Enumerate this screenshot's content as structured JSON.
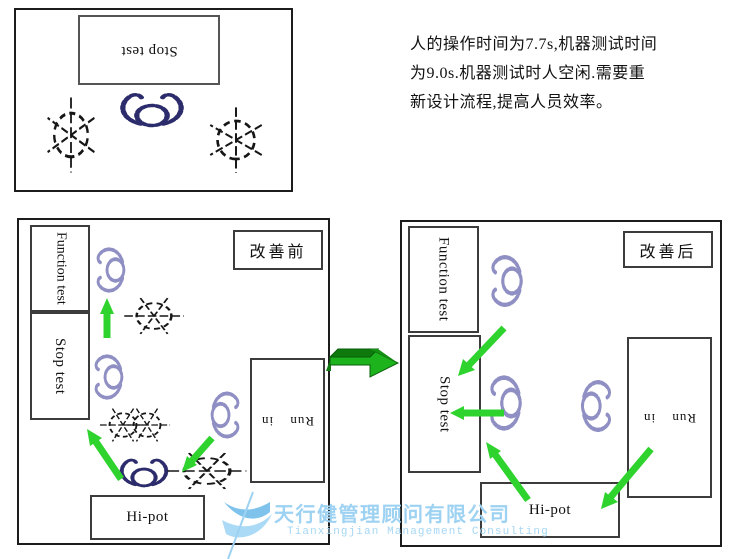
{
  "intro_panel": {
    "stop_test": "Stop test"
  },
  "note": {
    "text": "人的操作时间为7.7s,机器测试时间\n为9.0s.机器测试时人空闲.需要重\n新设计流程,提高人员效率。"
  },
  "before": {
    "title": "改善前",
    "function_test": "Function test",
    "stop_test": "Stop test",
    "run_in": "Run in",
    "hi_pot": "Hi-pot"
  },
  "after": {
    "title": "改善后",
    "function_test": "Function test",
    "stop_test": "Stop test",
    "run_in": "Run in",
    "hi_pot": "Hi-pot"
  },
  "watermark": {
    "company_cn": "天行健管理顾问有限公司",
    "company_en": "Tianxingjian Management Consulting"
  },
  "colors": {
    "flow_arrow_green": "#2ed32e",
    "improve_arrow_green": "#1db31d",
    "improve_arrow_dark_green": "#0e7a0e",
    "operator_lavender": "#8f8fc4",
    "operator_navy": "#2c2c6c",
    "watermark_blue": "#9ed2f2",
    "line_black": "#161616"
  }
}
